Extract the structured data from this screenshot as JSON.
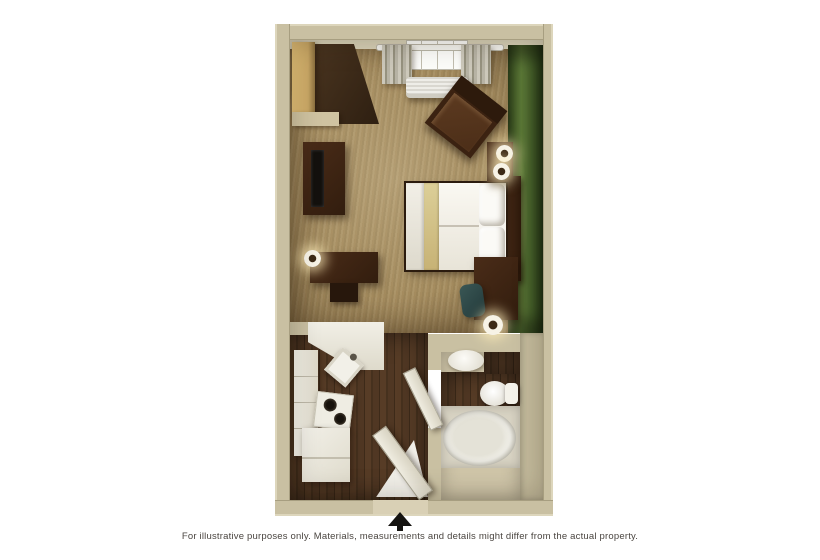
{
  "caption": {
    "text": "For illustrative purposes only.  Materials, measurements and details might differ from the actual property."
  },
  "icons": {
    "north_arrow": "north-arrow-up"
  },
  "palette": {
    "background": "#ffffff",
    "wall_tan": "#c9c0a2",
    "carpet_tan": "#a78e60",
    "wood_floor_brown": "#4e3521",
    "accent_wall_green": "#4e6b2f",
    "furniture_dark_brown": "#3c2414",
    "fixture_white": "#f2f0e8",
    "bed_runner_khaki": "#d4c48c",
    "chair_teal": "#2e4746",
    "caption_text": "#4a4540"
  },
  "rooms": [
    {
      "name": "bedroom-living-area"
    },
    {
      "name": "kitchen"
    },
    {
      "name": "bathroom"
    }
  ],
  "furniture": [
    "closet shelves",
    "wardrobe",
    "tv stand",
    "tv",
    "desk",
    "desk chair",
    "desk lamp",
    "bed",
    "headboard",
    "pillows",
    "nightstand",
    "twin lamps",
    "armchair",
    "window with curtains",
    "air conditioner",
    "side desk",
    "teal chair",
    "table lamp",
    "kitchen counter",
    "kitchen sink",
    "cooktop",
    "cabinets",
    "refrigerator",
    "vanity sink",
    "toilet",
    "bathtub",
    "bathroom door",
    "entry door"
  ]
}
